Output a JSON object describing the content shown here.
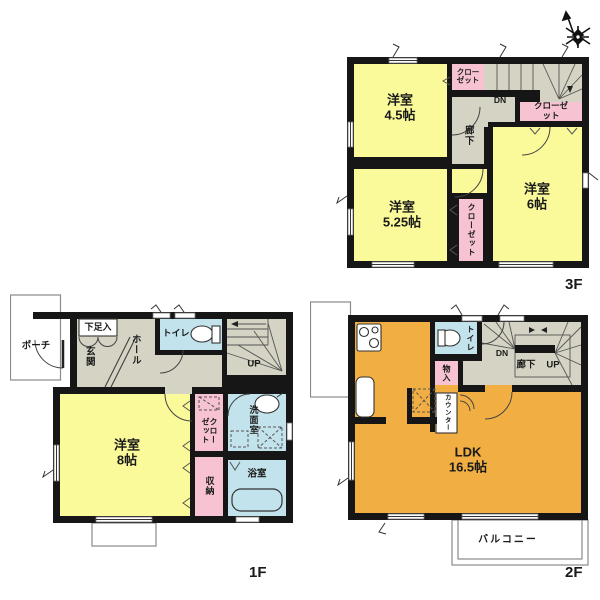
{
  "document": {
    "type": "floor-plan",
    "stories": 3
  },
  "colors": {
    "room_yellow": "#FAFA9A",
    "room_orange": "#F1AE43",
    "closet_pink": "#F7C3D2",
    "wet_blue": "#C2E3EB",
    "hall_gray": "#D5D3C3",
    "wall": "#161616",
    "thin_line": "#8A8A8A"
  },
  "compass": {
    "icon": "north-arrow-star"
  },
  "floors": {
    "f3": {
      "name": "3F",
      "rooms": {
        "bedroom45": "洋室\n4.5帖",
        "bedroom525": "洋室\n5.25帖",
        "bedroom6": "洋室\n6帖",
        "closet_top": "クロー\nゼット",
        "closet_right": "クローゼット",
        "closet_mid": "クローゼット",
        "hallway": "廊下",
        "stairs_dn": "DN"
      }
    },
    "f1": {
      "name": "1F",
      "rooms": {
        "porch": "ポーチ",
        "shoe_cabinet": "下足入",
        "entrance": "玄関",
        "hall": "ホール",
        "toilet": "トイレ",
        "stairs_up": "UP",
        "bedroom8": "洋室\n8帖",
        "closet": "クローゼット",
        "storage": "収納",
        "washroom": "洗面室",
        "bathroom": "浴室"
      }
    },
    "f2": {
      "name": "2F",
      "rooms": {
        "ldk": "LDK\n16.5帖",
        "toilet": "トイレ",
        "storage": "物入",
        "counter": "カウンター",
        "stairs_dn": "DN",
        "hallway": "廊下",
        "stairs_up": "UP",
        "balcony": "バルコニー"
      }
    }
  }
}
